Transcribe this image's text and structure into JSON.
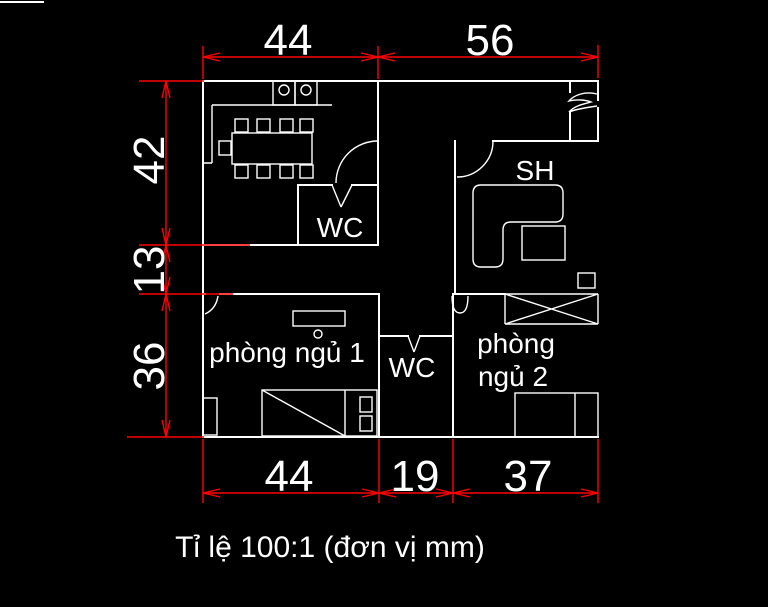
{
  "colors": {
    "background": "#000000",
    "wall": "#ffffff",
    "dimension": "#ff0000",
    "text": "#ffffff"
  },
  "dimensions": {
    "top": [
      "44",
      "56"
    ],
    "left": [
      "42",
      "13",
      "36"
    ],
    "bottom": [
      "44",
      "19",
      "37"
    ]
  },
  "labels": {
    "kitchen_wc": "WC",
    "living_room": "SH",
    "bedroom1": "phòng ngủ 1",
    "bathroom2": "WC",
    "bedroom2_line1": "phòng",
    "bedroom2_line2": "ngủ 2"
  },
  "caption": "Tỉ lệ 100:1 (đơn vị mm)"
}
